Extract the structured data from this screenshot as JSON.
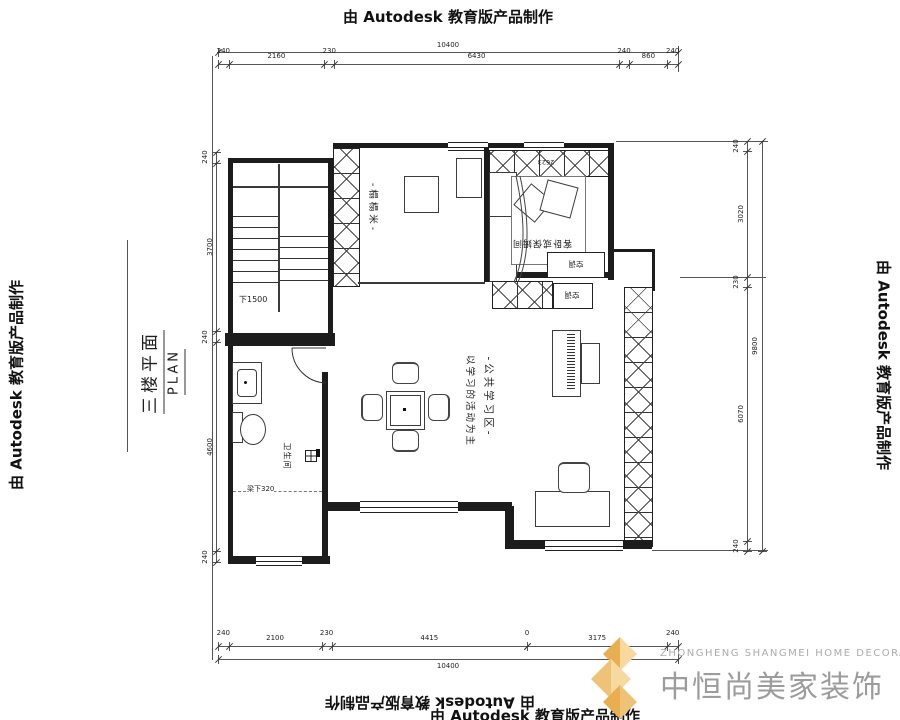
{
  "stamp": {
    "text": "由 Autodesk 教育版产品制作"
  },
  "title_block": {
    "title": "三楼平面",
    "plan_label": "PLAN"
  },
  "rooms": {
    "stair_note": "下1500",
    "bathroom": "卫生间",
    "beam_note": "梁下320",
    "tatami": "-榻榻米-",
    "guest_room": "客卧或保姆间",
    "ac_unit": "空调",
    "closet_dim": "2623",
    "study_line1": "-公共学习区-",
    "study_line2": "以学习的活动为主"
  },
  "logo": {
    "cn": "中恒尚美家装饰",
    "en": "ZHONGHENG SHANGMEI HOME DECORATION",
    "gold_dark": "#E8AE50",
    "gold_light": "#F5D99E",
    "gold_mid": "#EFC377",
    "text_gray": "#9C9C9C"
  },
  "dimensions": {
    "top": {
      "total": "10400",
      "segments": [
        "240",
        "2160",
        "230",
        "6430",
        "240",
        "860",
        "240"
      ]
    },
    "bottom": {
      "total": "10400",
      "segments": [
        "240",
        "2100",
        "230",
        "4415",
        "0",
        "3175",
        "240"
      ]
    },
    "right": {
      "total": "9800",
      "segments": [
        "240",
        "3020",
        "230",
        "6070",
        "240"
      ]
    },
    "left": {
      "segments": [
        "240",
        "3700",
        "240",
        "4600",
        "240"
      ]
    }
  }
}
